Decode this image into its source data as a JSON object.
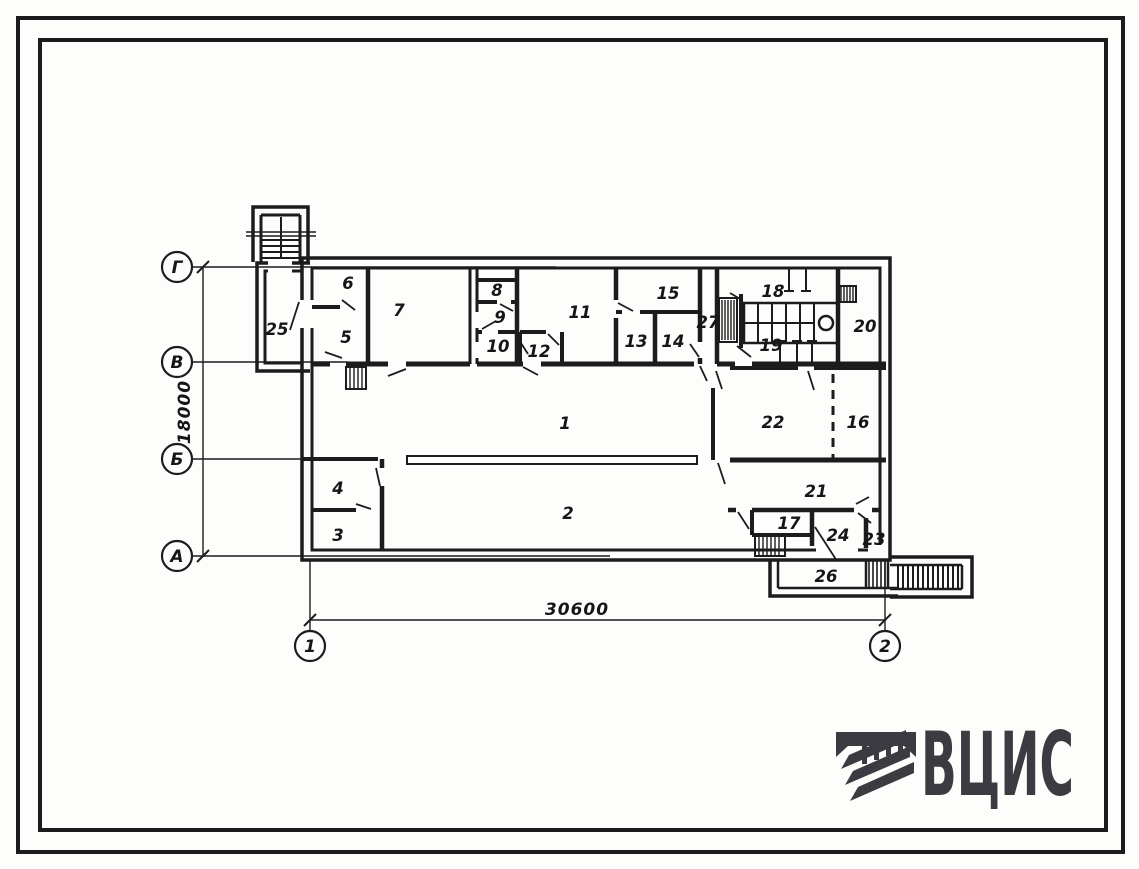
{
  "plan": {
    "rooms": [
      {
        "number": "1"
      },
      {
        "number": "2"
      },
      {
        "number": "3"
      },
      {
        "number": "4"
      },
      {
        "number": "5"
      },
      {
        "number": "6"
      },
      {
        "number": "7"
      },
      {
        "number": "8"
      },
      {
        "number": "9"
      },
      {
        "number": "10"
      },
      {
        "number": "11"
      },
      {
        "number": "12"
      },
      {
        "number": "13"
      },
      {
        "number": "14"
      },
      {
        "number": "15"
      },
      {
        "number": "16"
      },
      {
        "number": "17"
      },
      {
        "number": "18"
      },
      {
        "number": "19"
      },
      {
        "number": "20"
      },
      {
        "number": "21"
      },
      {
        "number": "22"
      },
      {
        "number": "23"
      },
      {
        "number": "24"
      },
      {
        "number": "25"
      },
      {
        "number": "26"
      },
      {
        "number": "27"
      }
    ],
    "row_axes": [
      {
        "label": "Г"
      },
      {
        "label": "В"
      },
      {
        "label": "Б"
      },
      {
        "label": "А"
      }
    ],
    "col_axes": [
      {
        "label": "1"
      },
      {
        "label": "2"
      }
    ],
    "dims": {
      "overall_width": "30600",
      "overall_height": "18000"
    }
  },
  "logo": {
    "text": "ВЦИС",
    "color": "#3b3b41"
  },
  "colors": {
    "ink": "#1c1c1c",
    "paper": "#fdfdfc"
  }
}
